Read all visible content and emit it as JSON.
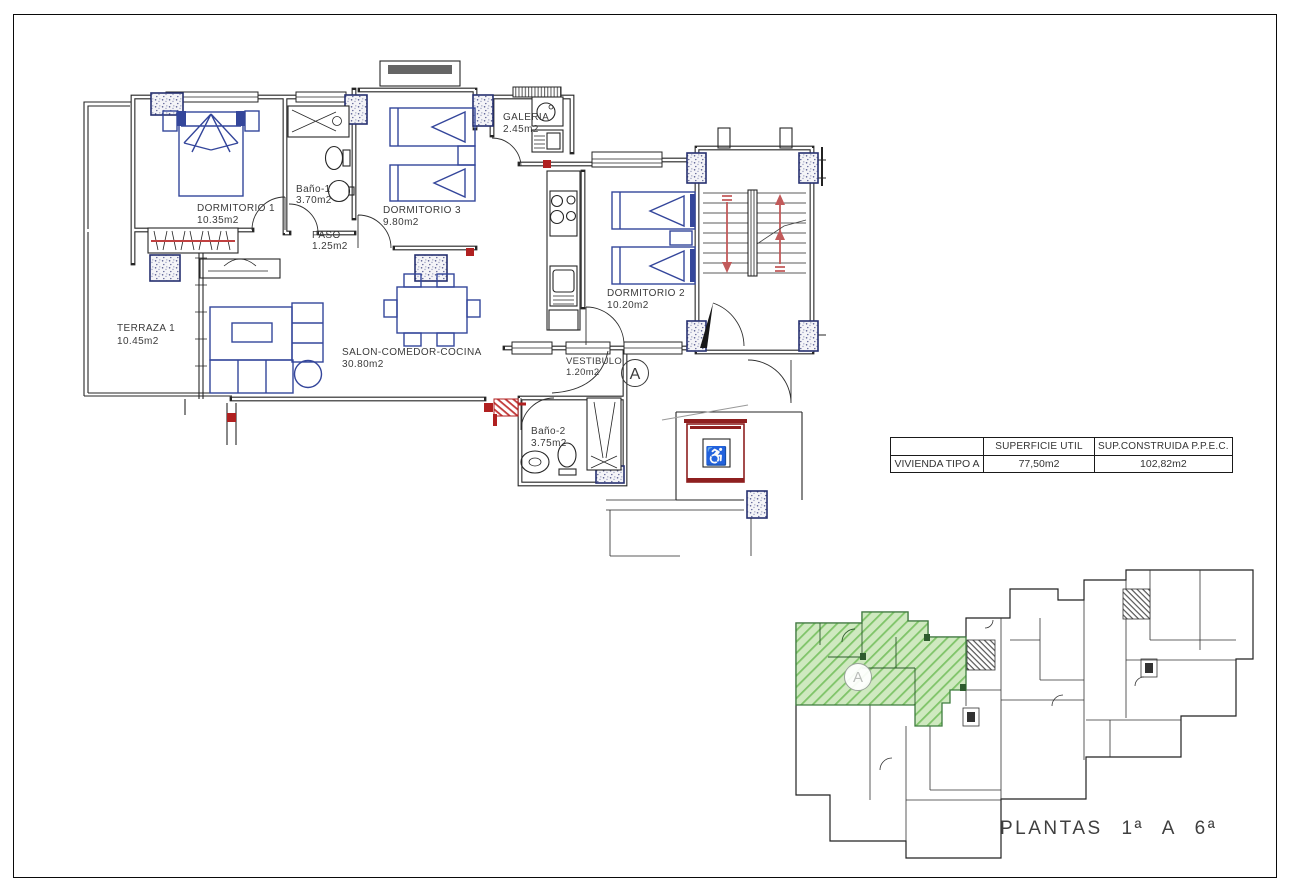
{
  "floor_plan": {
    "rooms": [
      {
        "id": "dormitorio-1",
        "name": "DORMITORIO 1",
        "area": "10.35m2"
      },
      {
        "id": "bano-1",
        "name": "Baño-1",
        "area": "3.70m2"
      },
      {
        "id": "dormitorio-3",
        "name": "DORMITORIO 3",
        "area": "9.80m2"
      },
      {
        "id": "galeria",
        "name": "GALERIA",
        "area": "2.45m2"
      },
      {
        "id": "paso",
        "name": "PASO",
        "area": "1.25m2"
      },
      {
        "id": "terraza-1",
        "name": "TERRAZA 1",
        "area": "10.45m2"
      },
      {
        "id": "salon",
        "name": "SALON-COMEDOR-COCINA",
        "area": "30.80m2"
      },
      {
        "id": "dormitorio-2",
        "name": "DORMITORIO 2",
        "area": "10.20m2"
      },
      {
        "id": "vestibulo",
        "name": "VESTIBULO",
        "area": "1.20m2"
      },
      {
        "id": "bano-2",
        "name": "Baño-2",
        "area": "3.75m2"
      }
    ],
    "unit_marker": "A",
    "icons": [
      "wheelchair-icon"
    ]
  },
  "summary_table": {
    "col_headers": [
      "",
      "SUPERFICIE UTIL",
      "SUP.CONSTRUIDA P.P.E.C."
    ],
    "row": {
      "label": "VIVIENDA TIPO A",
      "superficie_util": "77,50m2",
      "sup_construida": "102,82m2"
    }
  },
  "site_plan": {
    "caption": "PLANTAS 1ª A 6ª",
    "marker": "A"
  },
  "colors": {
    "wall": "#262626",
    "furniture": "#34469b",
    "accent": "#b02020",
    "text": "#3b3b3b",
    "highlight_fill": "#cfe9c0",
    "highlight_hatch": "#7fc469"
  }
}
